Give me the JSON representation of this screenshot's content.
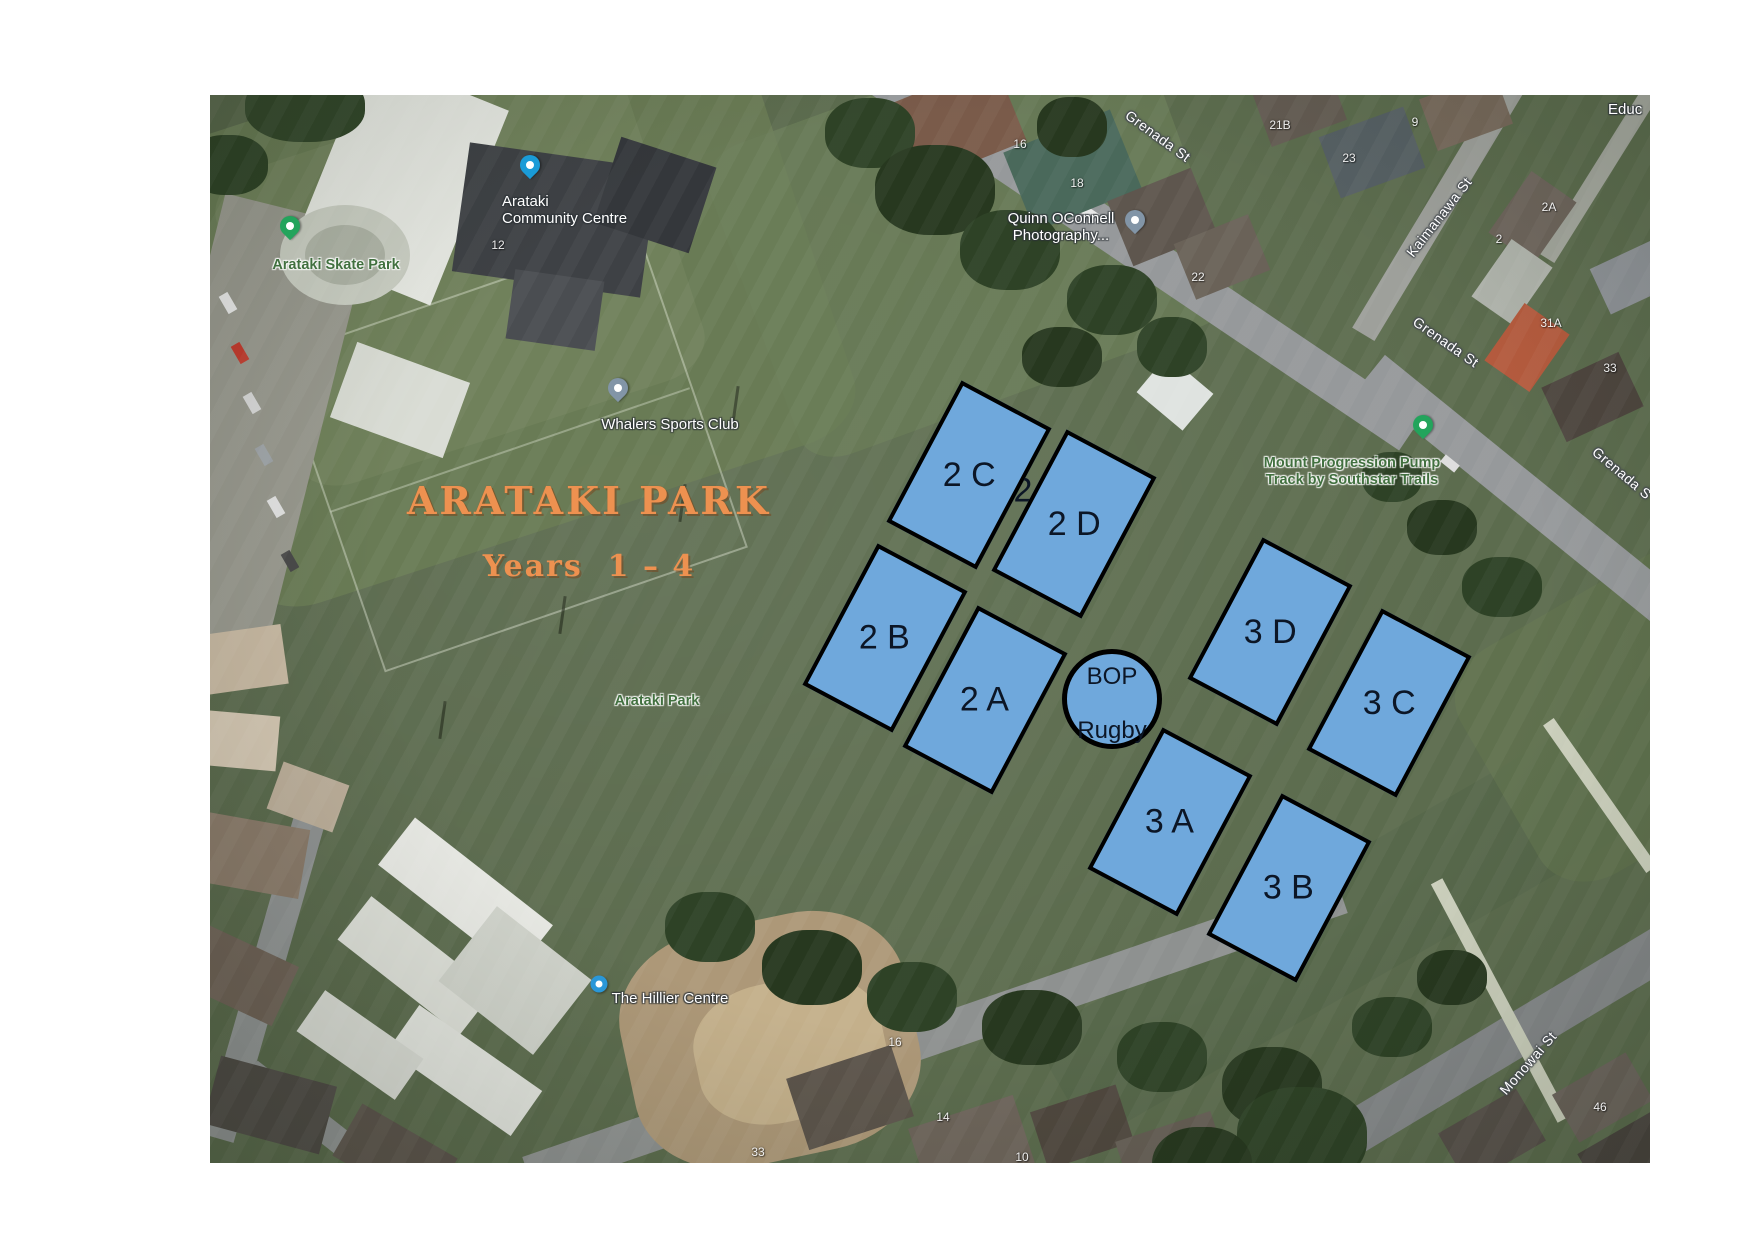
{
  "map_image": {
    "description": "Satellite map of Arataki Park with sports field overlay",
    "overlay": {
      "title": "ARATAKI PARK",
      "subtitle": "Years  1 – 4",
      "title_color": "#ED9150",
      "field_fill": "#6FA8DC",
      "field_border": "#000000",
      "field_label_color": "#0C1626",
      "fields": [
        {
          "id": "2C",
          "label": "2 C",
          "x": 759,
          "y": 380
        },
        {
          "id": "2D",
          "label": "2 D",
          "x": 864,
          "y": 429
        },
        {
          "id": "2B",
          "label": "2 B",
          "x": 675,
          "y": 543
        },
        {
          "id": "2A",
          "label": "2 A",
          "x": 775,
          "y": 605
        },
        {
          "id": "3D",
          "label": "3 D",
          "x": 1060,
          "y": 537
        },
        {
          "id": "3C",
          "label": "3 C",
          "x": 1179,
          "y": 608
        },
        {
          "id": "3A",
          "label": "3 A",
          "x": 960,
          "y": 727
        },
        {
          "id": "3B",
          "label": "3 B",
          "x": 1079,
          "y": 793
        }
      ],
      "circle": {
        "line1": "BOP",
        "line2": "Rugby",
        "x": 902,
        "y": 604
      },
      "stray_label": {
        "text": "2",
        "x": 813,
        "y": 396
      }
    },
    "google_labels": {
      "pois": [
        {
          "id": "arataki-community-centre",
          "lines": [
            "Arataki",
            "Community Centre"
          ],
          "x": 292,
          "y": 115,
          "style": "white",
          "align": "left",
          "pin": {
            "shape": "drop",
            "color": "#1A9BD7",
            "x": 320,
            "y": 72
          }
        },
        {
          "id": "arataki-skate-park",
          "lines": [
            "Arataki Skate Park"
          ],
          "x": 126,
          "y": 170,
          "style": "green",
          "align": "center",
          "pin": {
            "shape": "drop",
            "color": "#23A45C",
            "x": 80,
            "y": 133
          }
        },
        {
          "id": "whalers-sports-club",
          "lines": [
            "Whalers Sports Club"
          ],
          "x": 460,
          "y": 329,
          "style": "white",
          "align": "center",
          "pin": {
            "shape": "drop",
            "color": "#8295A7",
            "x": 408,
            "y": 295
          }
        },
        {
          "id": "quinn-oconnell-photography",
          "lines": [
            "Quinn OConnell",
            "Photography..."
          ],
          "x": 851,
          "y": 132,
          "style": "white",
          "align": "center",
          "pin": {
            "shape": "drop",
            "color": "#8295A7",
            "x": 925,
            "y": 127
          }
        },
        {
          "id": "mount-progression-pump-track",
          "lines": [
            "Mount Progression Pump",
            "Track by Southstar Trails"
          ],
          "x": 1142,
          "y": 377,
          "style": "green",
          "align": "center",
          "pin": {
            "shape": "drop",
            "color": "#23A45C",
            "x": 1213,
            "y": 332
          }
        },
        {
          "id": "arataki-park",
          "lines": [
            "Arataki Park"
          ],
          "x": 447,
          "y": 606,
          "style": "green",
          "align": "center"
        },
        {
          "id": "the-hillier-centre",
          "lines": [
            "The Hillier Centre"
          ],
          "x": 460,
          "y": 903,
          "style": "white",
          "align": "center",
          "pin": {
            "shape": "dot",
            "color": "#2A97D8",
            "x": 389,
            "y": 889
          }
        },
        {
          "id": "educ-partial",
          "lines": [
            "Educ"
          ],
          "x": 1398,
          "y": 14,
          "style": "white",
          "align": "left"
        }
      ],
      "streets": [
        {
          "text": "Grenada St",
          "x": 948,
          "y": 41,
          "rot": 36
        },
        {
          "text": "Grenada St",
          "x": 1236,
          "y": 247,
          "rot": 35
        },
        {
          "text": "Grenada S",
          "x": 1412,
          "y": 378,
          "rot": 40
        },
        {
          "text": "Kaimanawa St",
          "x": 1229,
          "y": 122,
          "rot": -52
        },
        {
          "text": "Monowai St",
          "x": 1318,
          "y": 968,
          "rot": -49
        }
      ],
      "house_numbers": [
        {
          "text": "16",
          "x": 810,
          "y": 49
        },
        {
          "text": "18",
          "x": 867,
          "y": 88
        },
        {
          "text": "21B",
          "x": 1070,
          "y": 30
        },
        {
          "text": "23",
          "x": 1139,
          "y": 63
        },
        {
          "text": "9",
          "x": 1205,
          "y": 27
        },
        {
          "text": "2A",
          "x": 1339,
          "y": 112
        },
        {
          "text": "2",
          "x": 1289,
          "y": 144
        },
        {
          "text": "31A",
          "x": 1341,
          "y": 228
        },
        {
          "text": "33",
          "x": 1400,
          "y": 273
        },
        {
          "text": "22",
          "x": 988,
          "y": 182
        },
        {
          "text": "12",
          "x": 288,
          "y": 150
        },
        {
          "text": "16",
          "x": 685,
          "y": 947
        },
        {
          "text": "14",
          "x": 733,
          "y": 1022
        },
        {
          "text": "33",
          "x": 548,
          "y": 1057
        },
        {
          "text": "10",
          "x": 812,
          "y": 1062
        },
        {
          "text": "46",
          "x": 1390,
          "y": 1012
        }
      ]
    }
  }
}
